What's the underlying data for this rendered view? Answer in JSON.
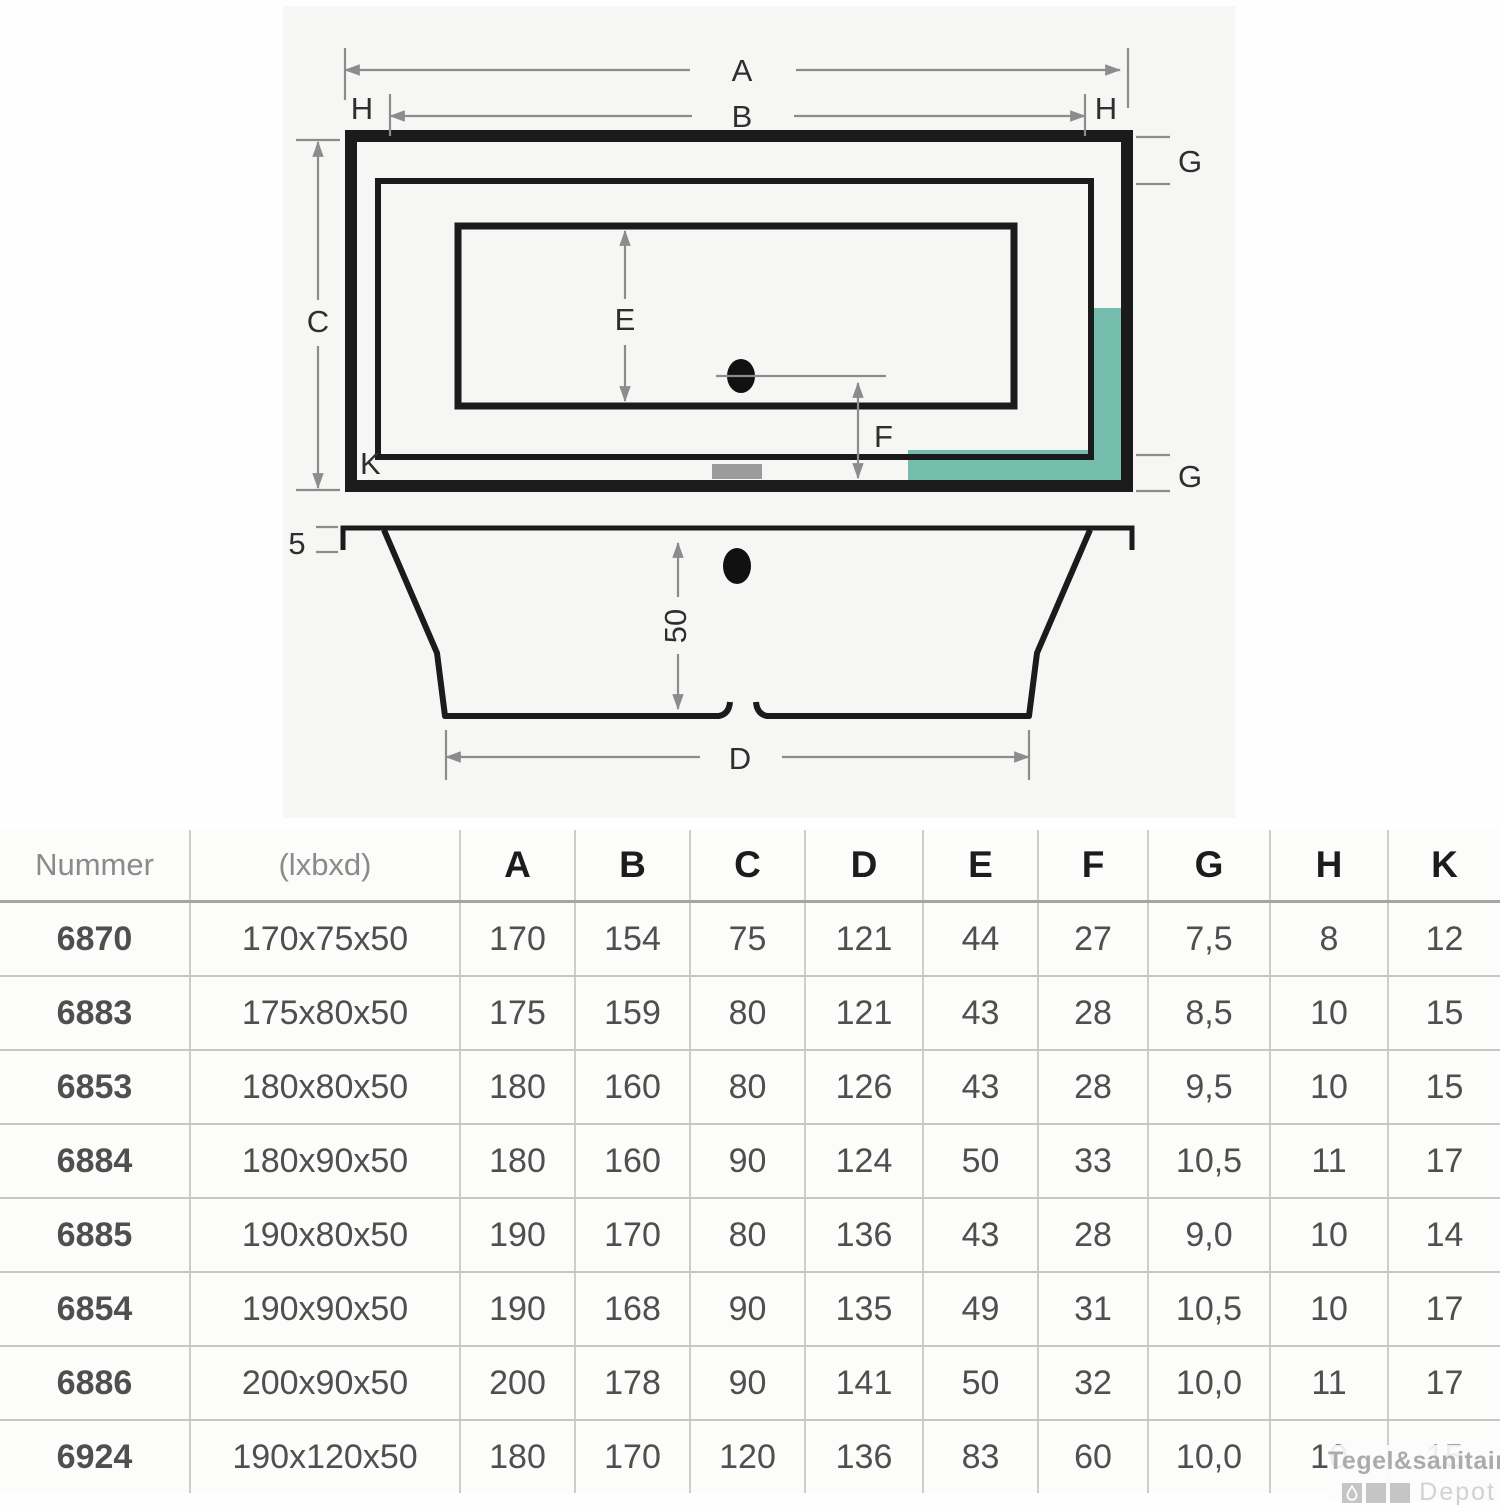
{
  "diagram": {
    "top_view_labels": {
      "a": "A",
      "b": "B",
      "c": "C",
      "e": "E",
      "f": "F",
      "k": "K",
      "h_left": "H",
      "h_right": "H",
      "g_top": "G",
      "g_bottom": "G"
    },
    "side_view_labels": {
      "rim": "5",
      "depth": "50",
      "d": "D"
    },
    "colors": {
      "teal": "#74bcab",
      "line": "#1b1b1b",
      "dim": "#8c8c8c",
      "slot_gray": "#9b9b9b"
    }
  },
  "table": {
    "headers": [
      "Nummer",
      "(lxbxd)",
      "A",
      "B",
      "C",
      "D",
      "E",
      "F",
      "G",
      "H",
      "K"
    ],
    "rows": [
      [
        "6870",
        "170x75x50",
        "170",
        "154",
        "75",
        "121",
        "44",
        "27",
        "7,5",
        "8",
        "12"
      ],
      [
        "6883",
        "175x80x50",
        "175",
        "159",
        "80",
        "121",
        "43",
        "28",
        "8,5",
        "10",
        "15"
      ],
      [
        "6853",
        "180x80x50",
        "180",
        "160",
        "80",
        "126",
        "43",
        "28",
        "9,5",
        "10",
        "15"
      ],
      [
        "6884",
        "180x90x50",
        "180",
        "160",
        "90",
        "124",
        "50",
        "33",
        "10,5",
        "11",
        "17"
      ],
      [
        "6885",
        "190x80x50",
        "190",
        "170",
        "80",
        "136",
        "43",
        "28",
        "9,0",
        "10",
        "14"
      ],
      [
        "6854",
        "190x90x50",
        "190",
        "168",
        "90",
        "135",
        "49",
        "31",
        "10,5",
        "10",
        "17"
      ],
      [
        "6886",
        "200x90x50",
        "200",
        "178",
        "90",
        "141",
        "50",
        "32",
        "10,0",
        "11",
        "17"
      ],
      [
        "6924",
        "190x120x50",
        "180",
        "170",
        "120",
        "136",
        "83",
        "60",
        "10,0",
        "10",
        "15"
      ]
    ]
  },
  "logo": {
    "line1": "Tegel&sanitair",
    "line2": "Depot"
  }
}
